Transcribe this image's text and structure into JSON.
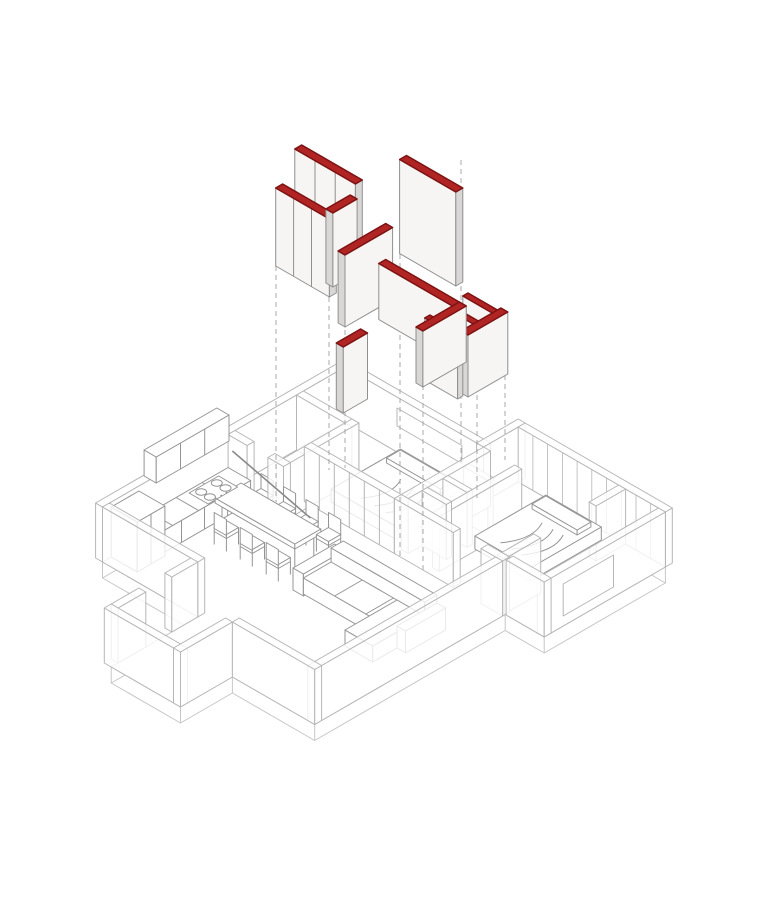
{
  "alt": "Exploded axonometric diagram of an apartment renovation: new partition wall panels capped in red float above the furnished wireframe floor plan, linked by vertical dashed projection lines",
  "colors": {
    "background": "#ffffff",
    "red_top": "#b12424",
    "red_stroke": "#7c1212",
    "panel_face": "#f6f5f3",
    "panel_side": "#d8d7d5",
    "panel_stroke": "#8f8f8f",
    "plan_stroke": "#b6b6b6",
    "wall_fill": "rgba(255,255,255,0.8)",
    "furn_stroke": "#949494",
    "dash_stroke": "#a8a8a8",
    "slab_stroke": "#c6c6c6"
  },
  "diagram": {
    "type": "axonometric-exploded",
    "iso": {
      "cx": 345,
      "cy": 422,
      "ex": 0.866,
      "ey": 0.5
    },
    "slab": {
      "depth": 16,
      "boundary": [
        [
          0,
          0
        ],
        [
          160,
          0
        ],
        [
          160,
          -40
        ],
        [
          330,
          -40
        ],
        [
          330,
          100
        ],
        [
          285,
          100
        ],
        [
          285,
          320
        ],
        [
          190,
          320
        ],
        [
          190,
          380
        ],
        [
          110,
          380
        ],
        [
          110,
          320
        ],
        [
          110,
          280
        ],
        [
          0,
          280
        ]
      ],
      "vertical_points": [
        [
          330,
          -40
        ],
        [
          330,
          100
        ],
        [
          285,
          100
        ],
        [
          285,
          320
        ],
        [
          190,
          320
        ],
        [
          190,
          380
        ],
        [
          110,
          380
        ],
        [
          110,
          320
        ],
        [
          110,
          280
        ],
        [
          0,
          280
        ]
      ]
    },
    "plan_items": [
      {
        "name": "outer-wall-nw",
        "box": [
          -8,
          0,
          0,
          280
        ],
        "ord": -3
      },
      {
        "name": "outer-wall-ne-small-bedroom",
        "box": [
          0,
          -8,
          160,
          0
        ],
        "ord": -2
      },
      {
        "name": "window-small-bedroom",
        "type": "quad",
        "pts": [
          [
            60,
            0,
            44
          ],
          [
            135,
            0,
            44
          ],
          [
            135,
            0,
            26
          ],
          [
            60,
            0,
            26
          ]
        ],
        "fill": "#ffffff",
        "ord": -1.5
      },
      {
        "name": "outer-wall-step",
        "box": [
          152,
          -48,
          160,
          0
        ],
        "ord": -1.2
      },
      {
        "name": "outer-wall-ne-glazing",
        "box": [
          160,
          -48,
          330,
          -40
        ],
        "mullions": 10,
        "ord": -1
      },
      {
        "name": "bath-wall-ne",
        "box": [
          0,
          48,
          64,
          56
        ]
      },
      {
        "name": "bath-wall-se",
        "box": [
          56,
          48,
          64,
          135
        ]
      },
      {
        "name": "bath-wall-sw-a",
        "box": [
          0,
          127,
          22,
          135
        ]
      },
      {
        "name": "bath-wall-sw-b",
        "box": [
          46,
          127,
          64,
          135
        ]
      },
      {
        "name": "wardrobe-wall",
        "box": [
          56,
          95,
          160,
          103
        ],
        "div": 6
      },
      {
        "name": "closet-wall-w",
        "box": [
          160,
          0,
          168,
          95
        ]
      },
      {
        "name": "closet-stub-1",
        "box": [
          168,
          25,
          196,
          31
        ]
      },
      {
        "name": "closet-stub-2",
        "box": [
          168,
          49,
          196,
          55
        ]
      },
      {
        "name": "closet-stub-3",
        "box": [
          168,
          73,
          196,
          79
        ]
      },
      {
        "name": "closet-wall-e",
        "box": [
          196,
          0,
          204,
          95
        ],
        "ord": 240
      },
      {
        "name": "bedroom-wall-se-a",
        "box": [
          160,
          95,
          228,
          103
        ]
      },
      {
        "name": "bedroom-wall-se-b",
        "box": [
          260,
          95,
          285,
          103
        ]
      },
      {
        "name": "terrace-divider-a",
        "box": [
          276,
          -40,
          284,
          -6
        ]
      },
      {
        "name": "terrace-divider-b",
        "box": [
          276,
          58,
          284,
          100
        ]
      },
      {
        "name": "terrace-wall-e",
        "box": [
          322,
          -40,
          330,
          100
        ]
      },
      {
        "name": "terrace-opening-frame",
        "type": "quad",
        "pts": [
          [
            330,
            20,
            42
          ],
          [
            330,
            78,
            42
          ],
          [
            330,
            78,
            10
          ],
          [
            330,
            20,
            10
          ]
        ],
        "fill": "none",
        "ord": 420
      },
      {
        "name": "terrace-parapet-s",
        "box": [
          286,
          92,
          330,
          100
        ]
      },
      {
        "name": "living-wall-se",
        "box": [
          277,
          103,
          285,
          320
        ]
      },
      {
        "name": "living-wall-s",
        "box": [
          190,
          312,
          285,
          320
        ]
      },
      {
        "name": "entry-wall-e",
        "box": [
          182,
          320,
          190,
          380
        ]
      },
      {
        "name": "entry-wall-s",
        "box": [
          102,
          372,
          190,
          380
        ]
      },
      {
        "name": "entry-wall-w-a",
        "box": [
          102,
          280,
          110,
          310
        ]
      },
      {
        "name": "entry-wall-w-b",
        "box": [
          102,
          340,
          110,
          372
        ]
      },
      {
        "name": "kitchen-wall-sw",
        "box": [
          0,
          272,
          110,
          280
        ]
      },
      {
        "name": "kitchen-upper-cabinets",
        "box": [
          0,
          148,
          14,
          232
        ],
        "z0": 62,
        "h": 26,
        "cls": "furn",
        "div": 3
      },
      {
        "name": "kitchen-counter",
        "box": [
          0,
          135,
          26,
          268
        ],
        "h": 22,
        "cls": "furn",
        "div": 5,
        "topLines": [
          165,
          195,
          225,
          250
        ]
      },
      {
        "name": "stove",
        "type": "stove",
        "at": [
          4,
          150
        ],
        "ord": 300
      },
      {
        "name": "kitchen-tall-cabinet",
        "box": [
          0,
          238,
          30,
          270
        ],
        "h": 50,
        "cls": "furn",
        "div": 2
      },
      {
        "name": "bed-small-bedroom",
        "type": "bed",
        "box": [
          72,
          8,
          148,
          88
        ],
        "h": 13,
        "pillow": [
          78,
          14,
          140,
          30
        ]
      },
      {
        "name": "bed-main-bedroom",
        "type": "bed",
        "box": [
          202,
          -30,
          266,
          52
        ],
        "h": 13,
        "pillow": [
          208,
          -24,
          260,
          -8
        ],
        "ord": 260
      },
      {
        "name": "dining-table",
        "type": "table",
        "box": [
          30,
          150,
          122,
          180
        ],
        "z0": 24,
        "h": 5
      },
      {
        "name": "pendant-light-bar",
        "type": "line3d",
        "from": [
          20,
          150,
          56
        ],
        "to": [
          132,
          172,
          56
        ],
        "ord": 400
      },
      {
        "name": "dining-chair-1",
        "type": "chair",
        "at": [
          42,
          139
        ],
        "back": "nw"
      },
      {
        "name": "dining-chair-2",
        "type": "chair",
        "at": [
          68,
          139
        ],
        "back": "nw"
      },
      {
        "name": "dining-chair-3",
        "type": "chair",
        "at": [
          94,
          139
        ],
        "back": "nw"
      },
      {
        "name": "dining-chair-4",
        "type": "chair",
        "at": [
          120,
          139
        ],
        "back": "nw"
      },
      {
        "name": "dining-chair-5",
        "type": "chair",
        "at": [
          54,
          191
        ],
        "back": "se"
      },
      {
        "name": "dining-chair-6",
        "type": "chair",
        "at": [
          84,
          191
        ],
        "back": "se"
      },
      {
        "name": "dining-chair-7",
        "type": "chair",
        "at": [
          114,
          191
        ],
        "back": "se"
      },
      {
        "name": "sofa-arm-left",
        "box": [
          138,
          150,
          150,
          198
        ],
        "h": 22,
        "cls": "furn"
      },
      {
        "name": "sofa-back",
        "box": [
          148,
          150,
          256,
          164
        ],
        "h": 30,
        "cls": "furn"
      },
      {
        "name": "sofa-seat",
        "box": [
          148,
          164,
          256,
          196
        ],
        "h": 16,
        "cls": "furn",
        "topLinesX": [
          184,
          220
        ]
      },
      {
        "name": "sofa-chaise",
        "box": [
          224,
          164,
          256,
          224
        ],
        "h": 16,
        "cls": "furn"
      },
      {
        "name": "sofa-arm-right",
        "box": [
          256,
          150,
          266,
          196
        ],
        "h": 22,
        "cls": "furn"
      }
    ],
    "projection_lines": [
      {
        "x": 276,
        "y1": 266,
        "y2": 502
      },
      {
        "x": 329,
        "y1": 297,
        "y2": 470
      },
      {
        "x": 345,
        "y1": 330,
        "y2": 468
      },
      {
        "x": 400,
        "y1": 254,
        "y2": 556
      },
      {
        "x": 423,
        "y1": 331,
        "y2": 574
      },
      {
        "x": 461,
        "y1": 160,
        "y2": 464
      },
      {
        "x": 477,
        "y1": 368,
        "y2": 498
      },
      {
        "x": 505,
        "y1": 312,
        "y2": 460
      }
    ],
    "panels": [
      {
        "name": "panel-bath-ne",
        "box": [
          0,
          50,
          70,
          58
        ],
        "z0": 222,
        "h": 80,
        "div": 3
      },
      {
        "name": "panel-bath-mid",
        "box": [
          0,
          72,
          62,
          80
        ],
        "z0": 196,
        "h": 78,
        "div": 3
      },
      {
        "name": "panel-bath-connector",
        "box": [
          58,
          52,
          66,
          80
        ],
        "z0": 208,
        "h": 74
      },
      {
        "name": "panel-bedroom-tall",
        "box": [
          95,
          24,
          160,
          32
        ],
        "z0": 232,
        "h": 94
      },
      {
        "name": "panel-bedroom-side",
        "box": [
          102,
          55,
          110,
          110
        ],
        "z0": 205,
        "h": 72
      },
      {
        "name": "panel-corridor-small",
        "box": [
          130,
          112,
          138,
          140
        ],
        "z0": 148,
        "h": 66
      },
      {
        "name": "panel-closet-long",
        "box": [
          115,
          68,
          208,
          76
        ],
        "z0": 198,
        "h": 56
      },
      {
        "name": "panel-closet-return",
        "box": [
          200,
          68,
          208,
          118
        ],
        "z0": 198,
        "h": 56
      },
      {
        "name": "panel-comb-1",
        "box": [
          164,
          22,
          202,
          28
        ],
        "z0": 160,
        "h": 62
      },
      {
        "name": "panel-comb-2",
        "box": [
          164,
          44,
          202,
          50
        ],
        "z0": 160,
        "h": 62
      },
      {
        "name": "panel-comb-3",
        "box": [
          164,
          66,
          202,
          72
        ],
        "z0": 160,
        "h": 62
      },
      {
        "name": "panel-comb-back",
        "box": [
          198,
          18,
          206,
          64
        ],
        "z0": 160,
        "h": 62
      }
    ]
  }
}
